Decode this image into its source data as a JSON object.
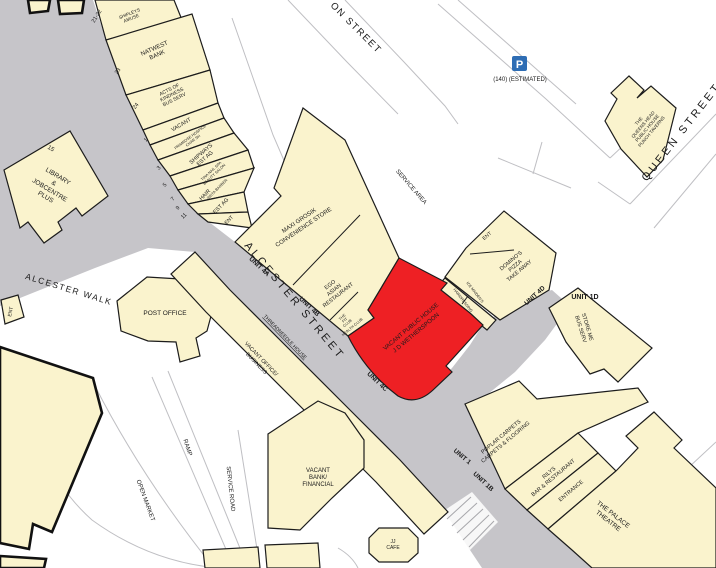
{
  "colors": {
    "building_fill": "#faf3cd",
    "highlight_fill": "#ee2024",
    "street_fill": "#c6c5c9",
    "parking_blue": "#2e6db4",
    "health_green": "#157a15"
  },
  "streets": {
    "alcester_street": "ALCESTER STREET",
    "alcester_walk": "ALCESTER WALK",
    "queen_street": "QUEEN STREET",
    "top_partial": "ON STREET",
    "service_area": "SERVICE AREA",
    "service_road": "SERVICE ROAD",
    "ramp": "RAMP",
    "open_market": "OPEN MARKET"
  },
  "parking": {
    "symbol": "P",
    "capacity": "(140) (ESTIMATED)"
  },
  "unit_labels": {
    "u4a": "UNIT 4A",
    "u4b": "UNIT 4B",
    "u4c": "UNIT 4C",
    "u4d": "UNIT 4D",
    "u1": "UNIT 1",
    "u1b": "UNIT 1B",
    "u1d": "UNIT 1D"
  },
  "street_numbers": {
    "n21_22": "21-22",
    "n23": "23",
    "n24": "24",
    "n1": "1",
    "n3": "3",
    "n5": "5",
    "n7": "7",
    "n9": "9",
    "n11": "11",
    "n15": "15"
  },
  "premises": {
    "shipleys": {
      "lines": [
        "SHIPLEYS",
        "AMUSE"
      ]
    },
    "natwest": {
      "lines": [
        "NATWEST",
        "BANK"
      ]
    },
    "acts_of_kindness": {
      "lines": [
        "ACTS OF",
        "KINDNESS",
        "BUS SERV"
      ]
    },
    "vacant_small": {
      "lines": [
        "VACANT"
      ]
    },
    "primrose": {
      "lines": [
        "PRIMROSE HOSPICE",
        "CHAR SH"
      ]
    },
    "shipways": {
      "lines": [
        "SHIPWAYS",
        "EST AG"
      ]
    },
    "tina_nail": {
      "lines": [
        "TINA NAIL SPA",
        "BEAUTY SALON"
      ]
    },
    "hair": {
      "lines": [
        "HAIR"
      ]
    },
    "insta_barber": {
      "lines": [
        "INSTA BARBER"
      ]
    },
    "est_ag": {
      "lines": [
        "EST AG"
      ]
    },
    "ent_a": {
      "lines": [
        "ENT"
      ]
    },
    "maxi_grosik": {
      "lines": [
        "MAXI GROSIK",
        "CONVENIENCE STORE"
      ]
    },
    "ego": {
      "lines": [
        "EGO",
        "ASIAN",
        "RESTAURANT"
      ]
    },
    "fit_club": {
      "lines": [
        "THE",
        "FIT",
        "CLUB"
      ]
    },
    "health_club": {
      "lines": [
        "HEALTH CLUB"
      ]
    },
    "wetherspoon": {
      "lines": [
        "VACANT PUBLIC HOUSE",
        "J D WETHERSPOON"
      ]
    },
    "hairdressing": {
      "lines": [
        "HAIRDRESSING"
      ]
    },
    "ice_maidens": {
      "lines": [
        "ICE MAIDEN'S"
      ]
    },
    "ent_b": {
      "lines": [
        "ENT"
      ]
    },
    "dominos": {
      "lines": [
        "DOMINO'S",
        "PIZZA",
        "TAKE AWAY"
      ]
    },
    "store_me": {
      "lines": [
        "STORE ME",
        "BUS SERV"
      ]
    },
    "poplar": {
      "lines": [
        "POPLAR CARPETS",
        "CARPETS & FLOORING"
      ]
    },
    "rilys": {
      "lines": [
        "RILYS",
        "BAR & RESTAURANT"
      ]
    },
    "entrance": {
      "lines": [
        "ENTRANCE"
      ]
    },
    "palace": {
      "lines": [
        "THE PALACE",
        "THEATRE"
      ]
    },
    "queens_head": {
      "lines": [
        "THE",
        "QUEENS HEAD",
        "PUBLIC HOUSE",
        "PUNCH TAVERNS"
      ]
    },
    "library": {
      "lines": [
        "LIBRARY",
        "&",
        "JOBCENTRE",
        "PLUS"
      ]
    },
    "post_office": {
      "lines": [
        "POST OFFICE"
      ]
    },
    "vacant_office": {
      "lines": [
        "VACANT OFFICE/",
        "BUSINESS"
      ]
    },
    "threadneedle": {
      "lines": [
        "THREADNEEDLE HOUSE"
      ]
    },
    "vacant_bank": {
      "lines": [
        "VACANT",
        "BANK/",
        "FINANCIAL"
      ]
    },
    "jj_cafe": {
      "lines": [
        "JJ",
        "CAFE"
      ]
    },
    "ent_c": {
      "lines": [
        "ENT"
      ]
    }
  }
}
